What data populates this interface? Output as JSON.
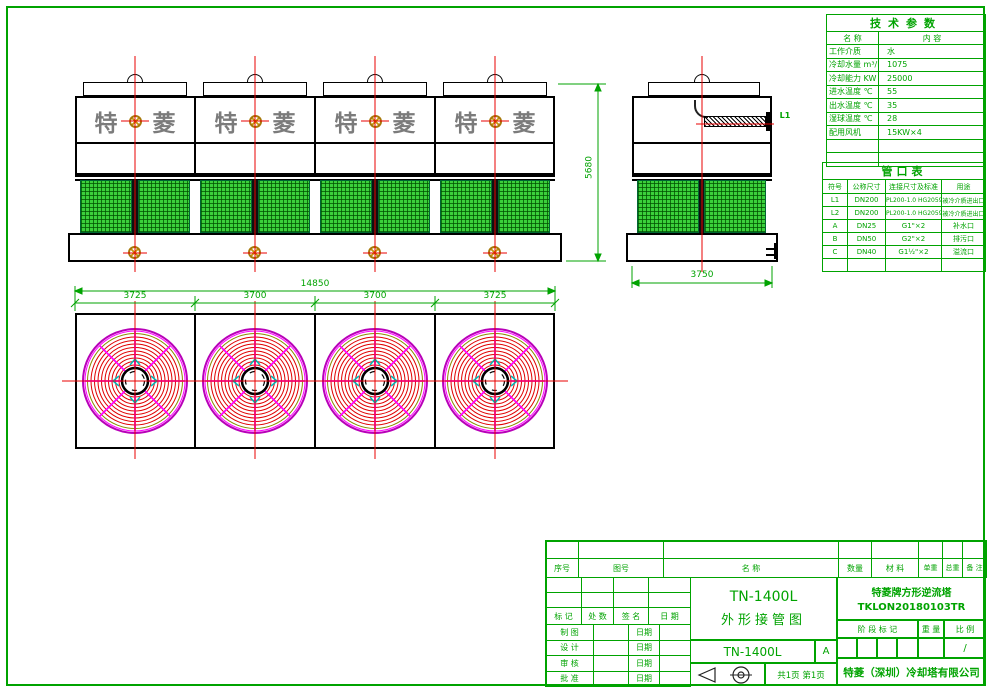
{
  "colors": {
    "line_green": "#00a300",
    "centerline_red": "#e80000",
    "fan_magenta": "#ff00ff",
    "fan_red": "#e00000",
    "mesh_green": "#3bd03b",
    "logo_gray": "#7b7b7b",
    "mark_orange": "#c8930c"
  },
  "icons": {
    "target_mark": "crosshair-circle",
    "projection": "first-angle-projection-symbol"
  },
  "front_view": {
    "logo_char1": "特",
    "logo_char2": "菱",
    "height_dim": "5680"
  },
  "side_view": {
    "width_dim": "3750",
    "pipe_label": "L1"
  },
  "plan_view": {
    "total_dim": "14850",
    "segment_dims": [
      "3725",
      "3700",
      "3700",
      "3725"
    ]
  },
  "tech_table": {
    "title": "技术参数",
    "col_headers": [
      "名  称",
      "内  容"
    ],
    "rows": [
      [
        "工作介质",
        "水"
      ],
      [
        "冷却水量 m³/h",
        "1075"
      ],
      [
        "冷却能力 KW",
        "25000"
      ],
      [
        "进水温度 ℃",
        "55"
      ],
      [
        "出水温度 ℃",
        "35"
      ],
      [
        "湿球温度 ℃",
        "28"
      ],
      [
        "配用风机",
        "15KW×4"
      ]
    ]
  },
  "pipe_table": {
    "title": "管口表",
    "col_headers": [
      "符号",
      "公称尺寸",
      "连接尺寸及标准",
      "用途"
    ],
    "rows": [
      [
        "L1",
        "DN200",
        "PL200-1.0 HG20593",
        "被冷介质进出口"
      ],
      [
        "L2",
        "DN200",
        "PL200-1.0 HG20593",
        "被冷介质进出口"
      ],
      [
        "A",
        "DN25",
        "G1\"×2",
        "补水口"
      ],
      [
        "B",
        "DN50",
        "G2\"×2",
        "排污口"
      ],
      [
        "C",
        "DN40",
        "G1½\"×2",
        "溢流口"
      ]
    ]
  },
  "title_block": {
    "parts_headers": [
      "序号",
      "图号",
      "名  称",
      "数量",
      "材  料",
      "单重",
      "总重",
      "备  注"
    ],
    "sign_headers": [
      "标 记",
      "处 数",
      "签  名",
      "日 期"
    ],
    "sign_labels": [
      "制 图",
      "设 计",
      "审 核",
      "批 准"
    ],
    "date_label": "日期",
    "drawing_title_line1": "TN-1400L",
    "drawing_title_line2": "外形接管图",
    "model": "TN-1400L",
    "rev": "A",
    "page_info": "共1页 第1页",
    "product_name": "特菱牌方形逆流塔",
    "drawing_no": "TKLON20180103TR",
    "stage_header": "阶 段 标 记",
    "weight_header": "重 量",
    "scale_header": "比 例",
    "scale_value": "/",
    "company": "特菱（深圳）冷却塔有限公司"
  }
}
